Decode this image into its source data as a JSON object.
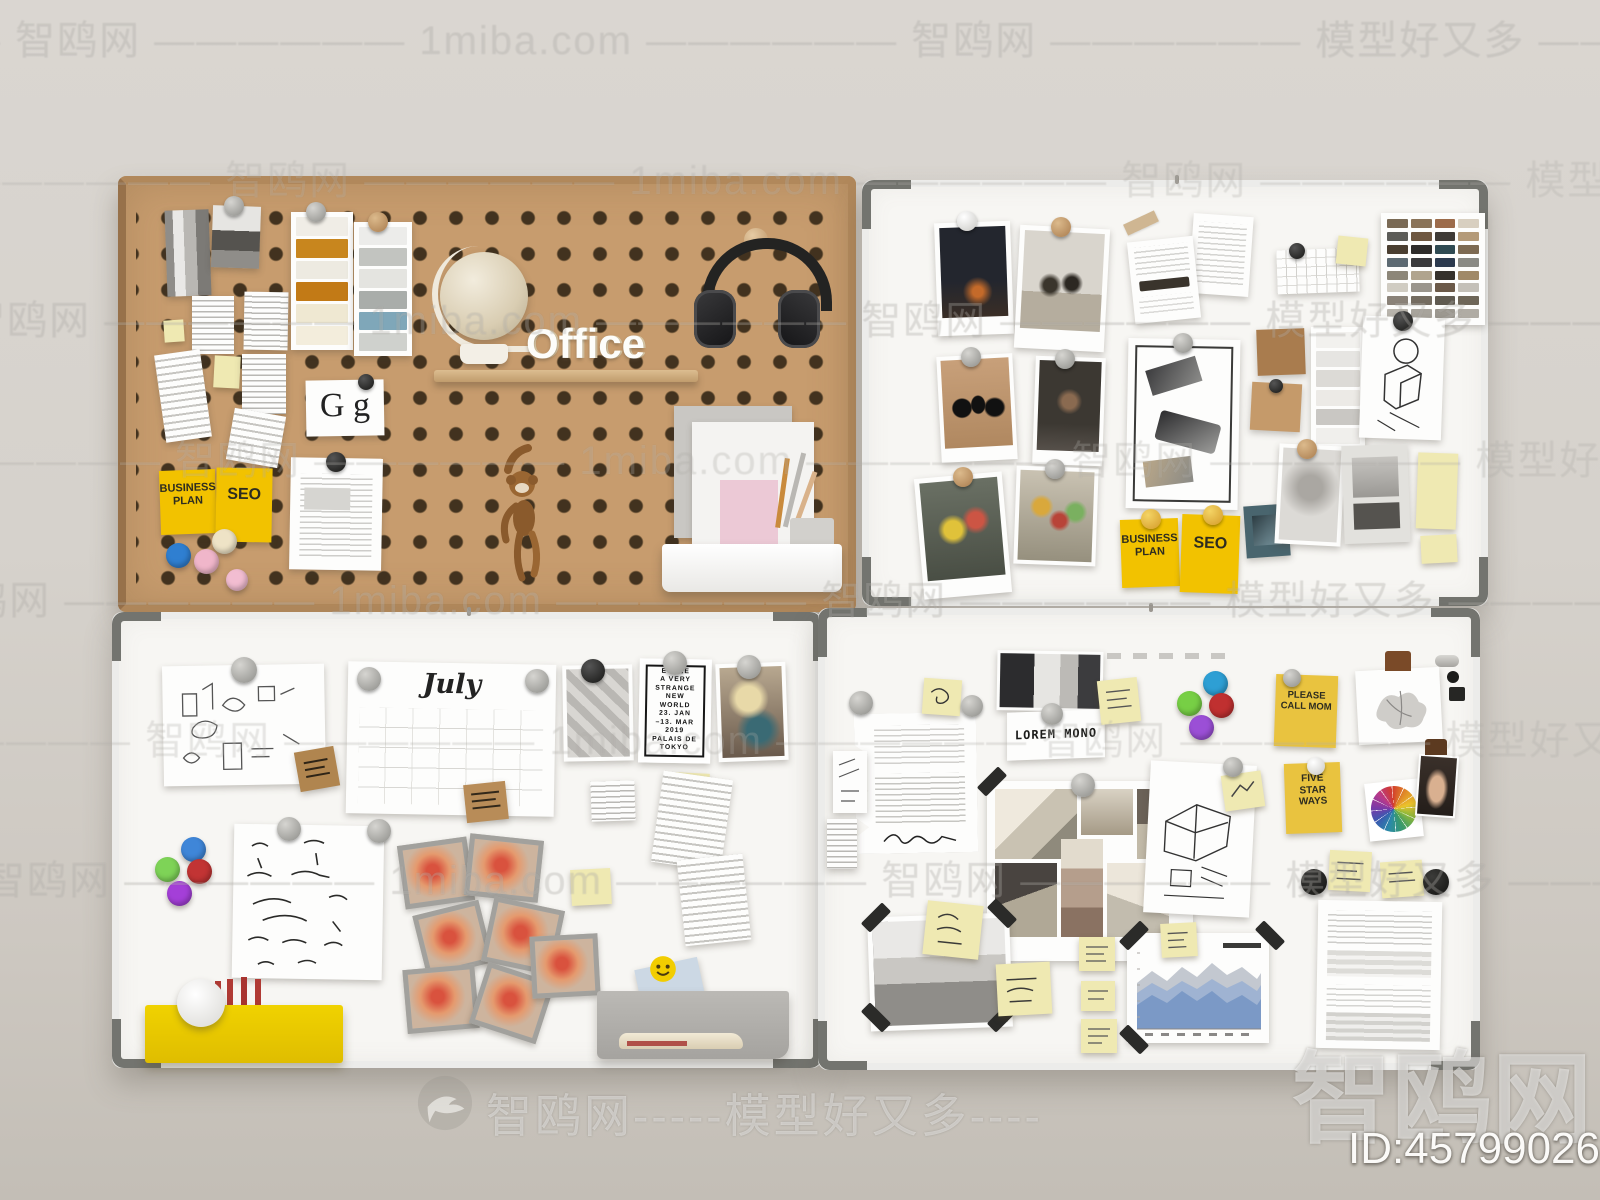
{
  "watermarks": {
    "line": "—————— 智鸥网 —————— 1miba.com —————— 智鸥网 —————— 模型好又多 —————— 1miba.com",
    "footer": "智鸥网-----模型好又多----",
    "corner_brand": "智鸥网",
    "id_label": "ID:457990262"
  },
  "pegboard": {
    "office_sign": "Office",
    "typography_card": "G g",
    "business_plan_note": "BUSINESS\nPLAN",
    "seo_note": "SEO"
  },
  "board_top_right": {
    "business_plan_note": "BUSINESS\nPLAN",
    "seo_note": "SEO"
  },
  "board_bottom_left": {
    "calendar_title": "July",
    "poster_text": "ECOLE\nA VERY\nSTRANGE\nNEW\nWORLD\n23. JAN\n–13. MAR\n2019\nPALAIS DE\nTOKYO"
  },
  "board_bottom_right": {
    "mono_card": "LOREM MONO",
    "call_note": "PLEASE\nCALL MOM",
    "star_note": "FIVE\nSTAR\nWAYS"
  },
  "palettes": {
    "swatch_grid": [
      "#7a6a55",
      "#8a7358",
      "#9c6b4a",
      "#d8cfc0",
      "#5c5c58",
      "#6e5740",
      "#3e3a36",
      "#b49a78",
      "#4a3e30",
      "#2e2c2a",
      "#2f4a52",
      "#7d6a52",
      "#5d6a72",
      "#3a3a3c",
      "#2c3a4e",
      "#8a8a84",
      "#8c8678",
      "#b0a48e",
      "#35312c",
      "#a08968",
      "#d0ccc2",
      "#9a958c",
      "#6b5948",
      "#c4c0b8",
      "#8a8278",
      "#746c60",
      "#5f5a50",
      "#6e6658",
      "#b8b4ac",
      "#a8a49c",
      "#9c9890",
      "#b0aca4"
    ],
    "paint_strip_warm": [
      "#f0ede6",
      "#c8861e",
      "#edeae1",
      "#c27a16",
      "#efe8d2",
      "#f3eddc"
    ],
    "paint_strip_cool": [
      "#ececea",
      "#c2c4c0",
      "#e4e4e0",
      "#a9adaa",
      "#7fa7b9",
      "#cfd1cd"
    ],
    "gray_strip": [
      "#f2f1ee",
      "#e6e5e2",
      "#dcdad6",
      "#eceae6",
      "#c9c7c3",
      "#f0efec"
    ],
    "pegboard_magnets": [
      "#eee3c6",
      "#2f7fd1",
      "#f0b6ca",
      "#f2bdd1"
    ],
    "cluster_bottom_left": [
      "#3f86d8",
      "#7ed357",
      "#c23434",
      "#a43fd8"
    ],
    "cluster_bottom_right": [
      "#2e9fd4",
      "#77cf45",
      "#c03030",
      "#9b4fd6"
    ],
    "chart_layers": [
      "#c3c8d0",
      "#9fb3d2",
      "#7b99c6"
    ],
    "wall": "#d6d2cb",
    "pegboard_wood": "#c79c6e",
    "sticky_bright": "#f2c200",
    "tray_yellow": "#e9c800",
    "marker_red": "#b03a34"
  }
}
